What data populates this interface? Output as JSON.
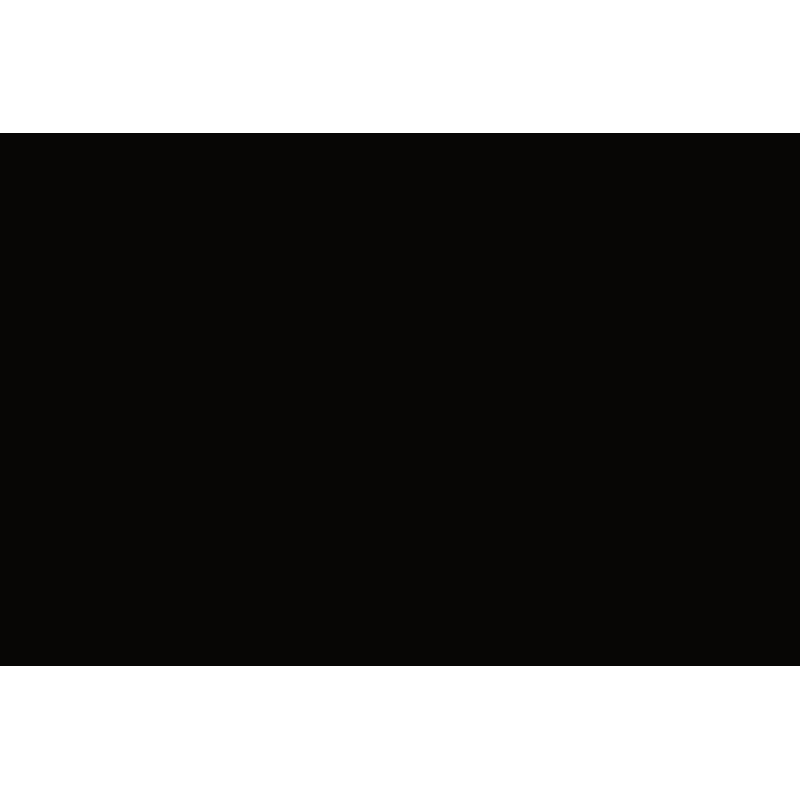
{
  "meta": {
    "alt": "Product photograph of an injection-moulded model-kit sprue: desert-tan plastic truck parts attached to a rectangular runner frame, shot on a black background with a white page border"
  },
  "colors": {
    "page_bg": "#ffffff",
    "photo_bg": "#070605",
    "photo_tint": "#10142a",
    "rail_light": "#d9cfab",
    "rail_mid": "#b7ac85",
    "rail_dark": "#857a5b",
    "plastic_light": "#e3dabb",
    "plastic_mid": "#b9ae87",
    "plastic_dark": "#7e7354",
    "plastic_shadow": "#4c4433",
    "brass_accent": "#9a823f",
    "glazing_gray": "#5a564d",
    "mesh_dark": "#4e4430"
  },
  "sprue": {
    "material": "desert-tan styrene",
    "background": "black studio backdrop",
    "frame_shape": "rounded rectangle with internal runners",
    "parts": [
      {
        "name": "Two-section treadplate panel",
        "qty": 1
      },
      {
        "name": "Three-section treadplate panel",
        "qty": 1
      },
      {
        "name": "Exhaust heat shield with mesh guard",
        "qty": 1
      },
      {
        "name": "Muffler with curved tailpipe",
        "qty": 1
      },
      {
        "name": "Mirror arm (left)",
        "qty": 1
      },
      {
        "name": "Mirror arm (right)",
        "qty": 1
      },
      {
        "name": "Spare-wheel cover with bolt ring",
        "qty": 1
      },
      {
        "name": "Radiator mesh grille",
        "qty": 1
      },
      {
        "name": "Canvas tilt panel (upper)",
        "qty": 1
      },
      {
        "name": "Canvas tilt panel (lower)",
        "qty": 1
      },
      {
        "name": "Wheel hub ring",
        "qty": 2
      },
      {
        "name": "Mud flap",
        "qty": 1
      },
      {
        "name": "Towing eye",
        "qty": 1
      },
      {
        "name": "Step bracket",
        "qty": 1
      },
      {
        "name": "Air tank",
        "qty": 4
      },
      {
        "name": "Runner hub disc",
        "qty": 1
      },
      {
        "name": "Torsion bar",
        "qty": 1
      },
      {
        "name": "Drive shaft with universal joints",
        "qty": 1
      },
      {
        "name": "Transfer gearbox with bell housing",
        "qty": 1
      },
      {
        "name": "Cab rear wall panel (left)",
        "qty": 1
      },
      {
        "name": "Cab rear wall panel (centre)",
        "qty": 1
      },
      {
        "name": "Cab rear wall panel (right)",
        "qty": 1
      },
      {
        "name": "Cab cowl",
        "qty": 1
      },
      {
        "name": "Dashboard with vent grilles",
        "qty": 1
      },
      {
        "name": "Parcel shelf",
        "qty": 1
      },
      {
        "name": "Glazing strip",
        "qty": 1
      },
      {
        "name": "Door inner panel",
        "qty": 2
      },
      {
        "name": "Pedal plate",
        "qty": 2
      },
      {
        "name": "Air filter drum",
        "qty": 1
      },
      {
        "name": "Seat",
        "qty": 2
      },
      {
        "name": "Seat back cushion",
        "qty": 2
      },
      {
        "name": "Cab floor and back panel with window opening",
        "qty": 1
      }
    ]
  }
}
